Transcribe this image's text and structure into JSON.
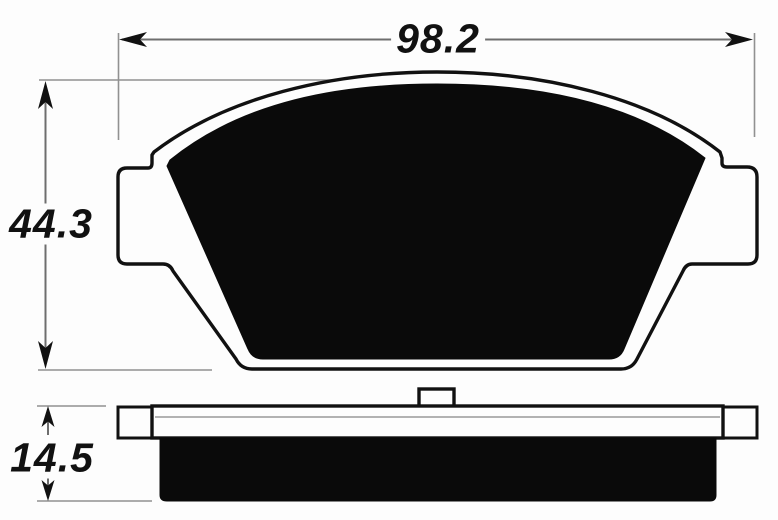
{
  "diagram": {
    "type": "technical-dimension-drawing",
    "subject": "brake-pad",
    "views": {
      "front_view": "pad outline with side ears and friction material",
      "side_view": "backing plate with tabs, center nub and friction block"
    },
    "dimensions": {
      "width_label": "98.2",
      "height_label": "44.3",
      "thickness_label": "14.5"
    },
    "colors": {
      "background": "#fdfdfd",
      "ink": "#111111",
      "friction_fill": "#0a0a0a",
      "dimension_line": "#6e6e6e",
      "extension_line": "#919191",
      "plate_inner_line": "#9a9a9a"
    }
  }
}
